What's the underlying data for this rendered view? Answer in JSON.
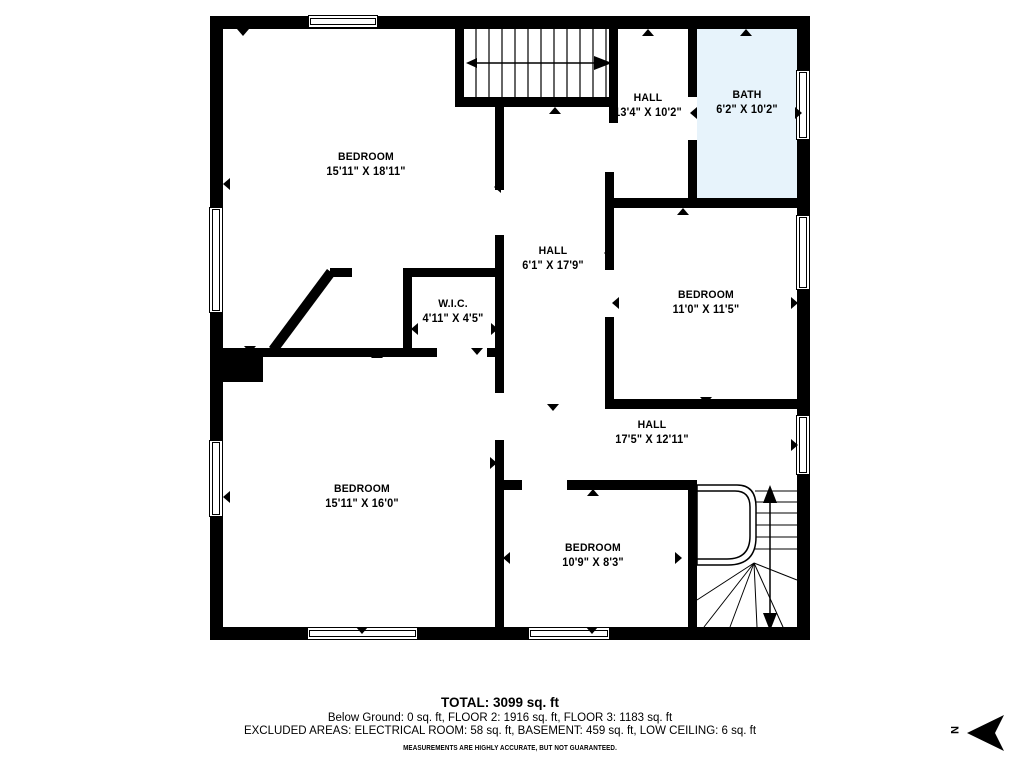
{
  "colors": {
    "wall": "#000000",
    "bath_fill": "#E7F3FB",
    "background": "#FFFFFF",
    "text": "#000000"
  },
  "rooms": [
    {
      "name": "BEDROOM",
      "dims": "15'11\" X 18'11\""
    },
    {
      "name": "HALL",
      "dims": "13'4\" X 10'2\""
    },
    {
      "name": "BATH",
      "dims": "6'2\" X 10'2\""
    },
    {
      "name": "HALL",
      "dims": "6'1\" X 17'9\""
    },
    {
      "name": "BEDROOM",
      "dims": "11'0\" X 11'5\""
    },
    {
      "name": "W.I.C.",
      "dims": "4'11\" X 4'5\""
    },
    {
      "name": "HALL",
      "dims": "17'5\" X 12'11\""
    },
    {
      "name": "BEDROOM",
      "dims": "15'11\" X 16'0\""
    },
    {
      "name": "BEDROOM",
      "dims": "10'9\" X 8'3\""
    }
  ],
  "summary": {
    "total": "TOTAL: 3099 sq. ft",
    "floors": "Below Ground: 0 sq. ft, FLOOR 2: 1916 sq. ft, FLOOR 3: 1183 sq. ft",
    "excluded": "EXCLUDED AREAS: ELECTRICAL ROOM: 58 sq. ft, BASEMENT: 459 sq. ft, LOW CEILING: 6 sq. ft",
    "disclaimer": "MEASUREMENTS ARE HIGHLY ACCURATE, BUT NOT GUARANTEED."
  },
  "compass": {
    "label": "N"
  }
}
